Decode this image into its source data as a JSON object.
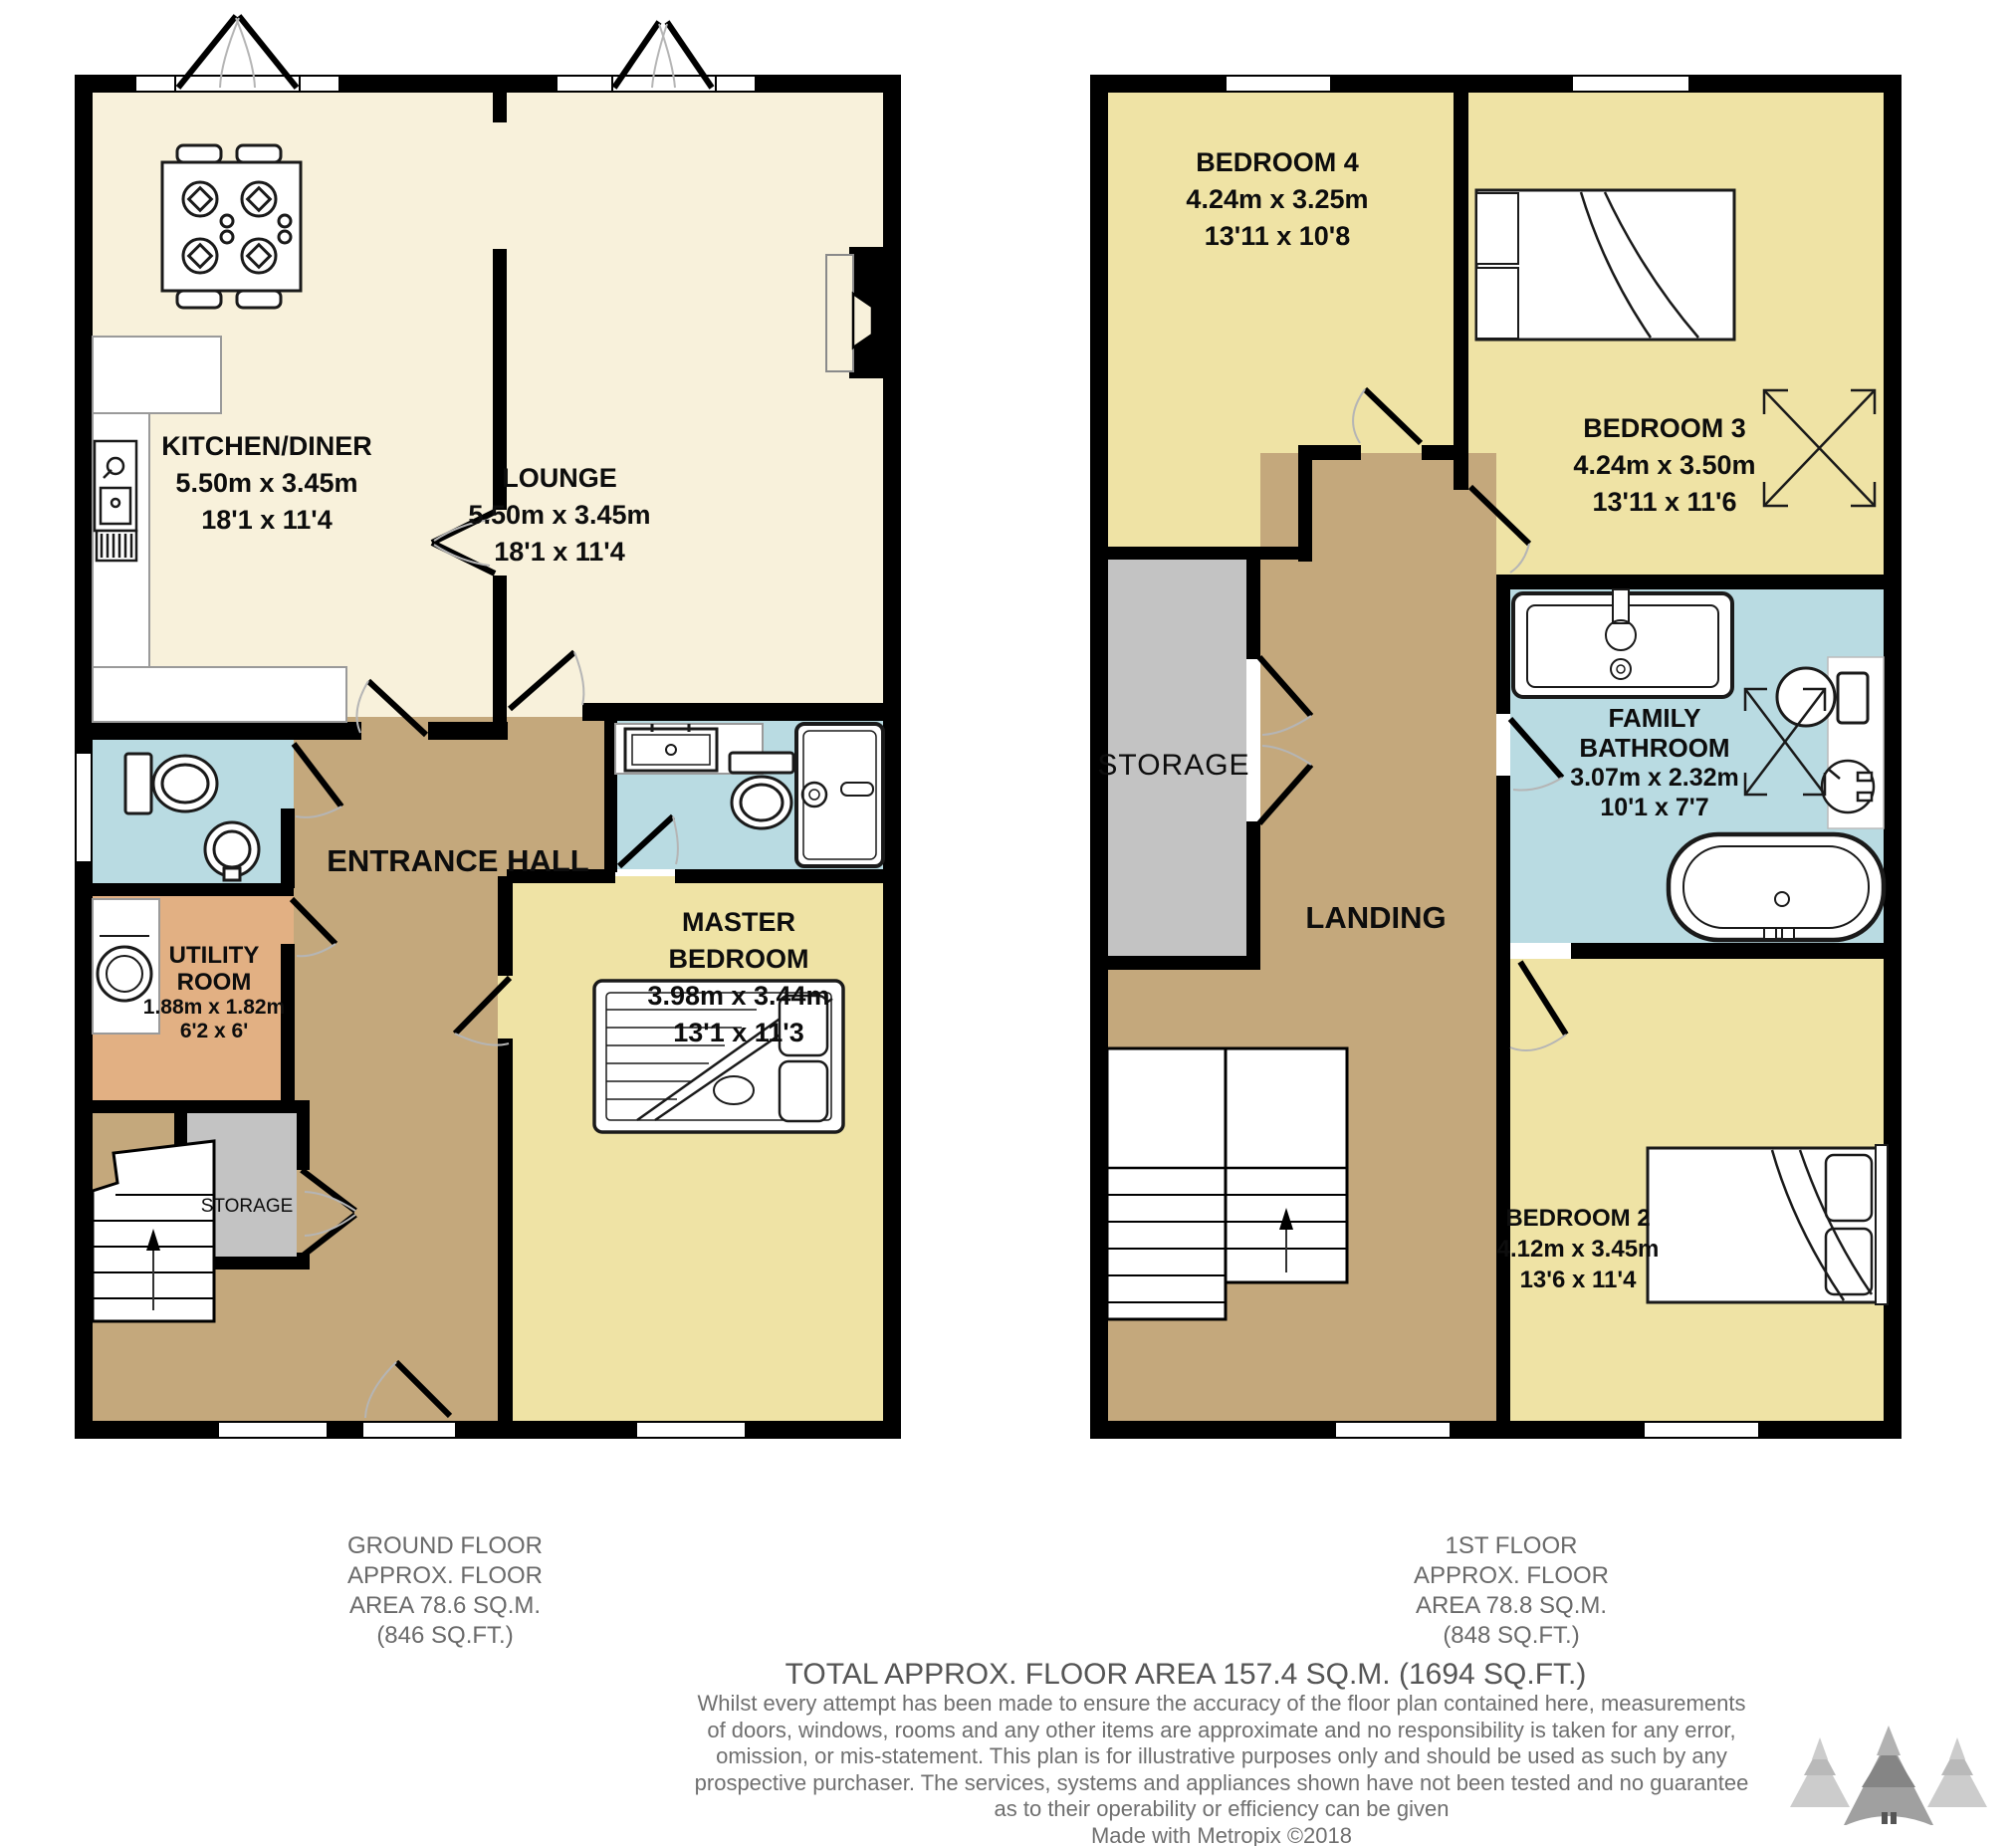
{
  "ground_floor": {
    "rooms": {
      "kitchen_diner": {
        "name": "KITCHEN/DINER",
        "metric": "5.50m x 3.45m",
        "imperial": "18'1 x 11'4"
      },
      "lounge": {
        "name": "LOUNGE",
        "metric": "5.50m x 3.45m",
        "imperial": "18'1 x 11'4"
      },
      "entrance_hall": {
        "name": "ENTRANCE HALL"
      },
      "utility_room": {
        "name": "UTILITY ROOM",
        "metric": "1.88m x 1.82m",
        "imperial": "6'2 x 6'"
      },
      "storage": {
        "name": "STORAGE"
      },
      "master_bedroom": {
        "name": "MASTER BEDROOM",
        "metric": "3.98m x 3.44m",
        "imperial": "13'1 x 11'3"
      }
    },
    "caption": [
      "GROUND FLOOR",
      "APPROX. FLOOR",
      "AREA 78.6 SQ.M.",
      "(846 SQ.FT.)"
    ]
  },
  "first_floor": {
    "rooms": {
      "bedroom_4": {
        "name": "BEDROOM 4",
        "metric": "4.24m x 3.25m",
        "imperial": "13'11 x 10'8"
      },
      "bedroom_3": {
        "name": "BEDROOM 3",
        "metric": "4.24m x 3.50m",
        "imperial": "13'11 x 11'6"
      },
      "family_bathroom": {
        "name": "FAMILY BATHROOM",
        "metric": "3.07m x 2.32m",
        "imperial": "10'1 x 7'7"
      },
      "storage": {
        "name": "STORAGE"
      },
      "landing": {
        "name": "LANDING"
      },
      "bedroom_2": {
        "name": "BEDROOM 2",
        "metric": "4.12m x 3.45m",
        "imperial": "13'6 x 11'4"
      }
    },
    "caption": [
      "1ST FLOOR",
      "APPROX. FLOOR",
      "AREA 78.8 SQ.M.",
      "(848 SQ.FT.)"
    ]
  },
  "footer": {
    "total": "TOTAL APPROX. FLOOR AREA 157.4 SQ.M. (1694 SQ.FT.)",
    "disclaimer": [
      "Whilst every attempt has been made to ensure the accuracy of the floor plan contained here, measurements",
      "of doors, windows, rooms and any other items are approximate and no responsibility is taken for any error,",
      "omission, or mis-statement. This plan is for illustrative purposes only and should be used as such by any",
      "prospective purchaser. The services, systems and appliances shown have not been tested and no guarantee",
      "as to their operability or efficiency can be given"
    ],
    "credit": "Made with Metropix ©2018"
  },
  "colors": {
    "wall": "#000000",
    "living_cream": "#F8F1DB",
    "bedroom_yellow": "#EFE3A5",
    "bathroom_blue": "#B9DBE2",
    "hall_tan": "#C4A87C",
    "utility_orange": "#E2B083",
    "storage_grey": "#C3C3C3",
    "caption_grey": "#6A6A6A",
    "logo_grey": "#9E9E9E"
  }
}
